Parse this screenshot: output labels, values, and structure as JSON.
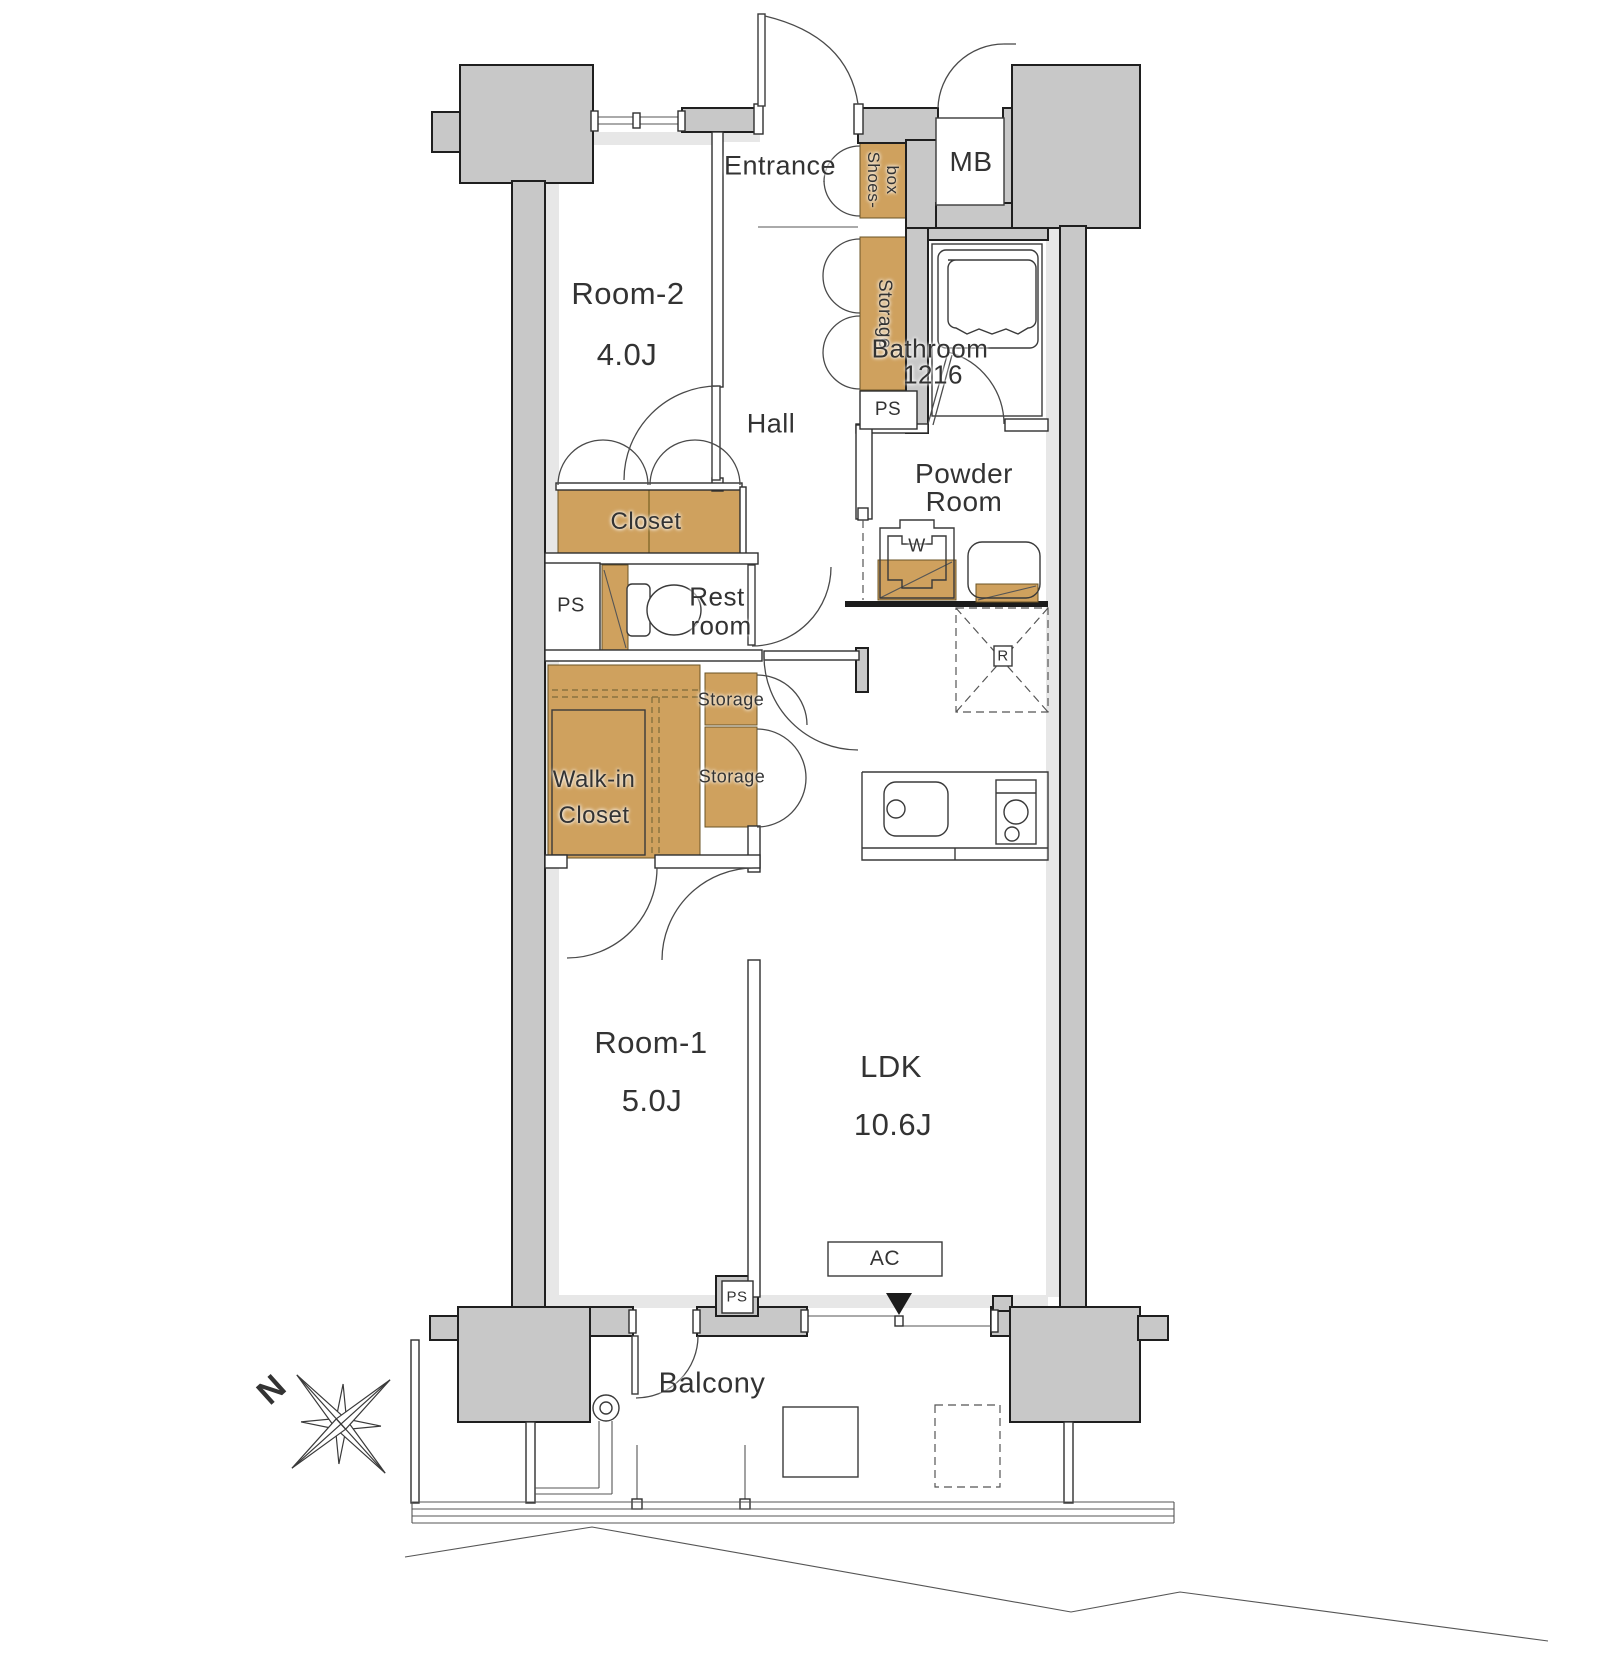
{
  "meta": {
    "type": "apartment-floor-plan",
    "compass_rotation_deg": -42
  },
  "colors": {
    "wall": "#c8c8c8",
    "wall_lining": "#e7e7e7",
    "fixture_tan": "#cfa15e",
    "line": "#333333",
    "floor": "#ffffff"
  },
  "rooms": {
    "room2": {
      "name": "Room-2",
      "size": "4.0J"
    },
    "room1": {
      "name": "Room-1",
      "size": "5.0J"
    },
    "ldk": {
      "name": "LDK",
      "size": "10.6J"
    },
    "bathroom": {
      "name": "Bathroom",
      "size": "1216"
    },
    "entrance": "Entrance",
    "hall": "Hall",
    "powder": {
      "line1": "Powder",
      "line2": "Room"
    },
    "restroom": {
      "line1": "Rest",
      "line2": "room"
    },
    "balcony": "Balcony"
  },
  "fixtures": {
    "shoes_box": {
      "line1": "Shoes-",
      "line2": "box"
    },
    "meter_box": "MB",
    "storage_hall": "Storage",
    "storage_a": "Storage",
    "storage_b": "Storage",
    "closet": "Closet",
    "walk_in_closet": {
      "line1": "Walk-in",
      "line2": "Closet"
    },
    "washer": "W",
    "refrigerator": "R",
    "air_conditioner": "AC",
    "pipe_space": "PS"
  },
  "compass": {
    "north": "N"
  }
}
